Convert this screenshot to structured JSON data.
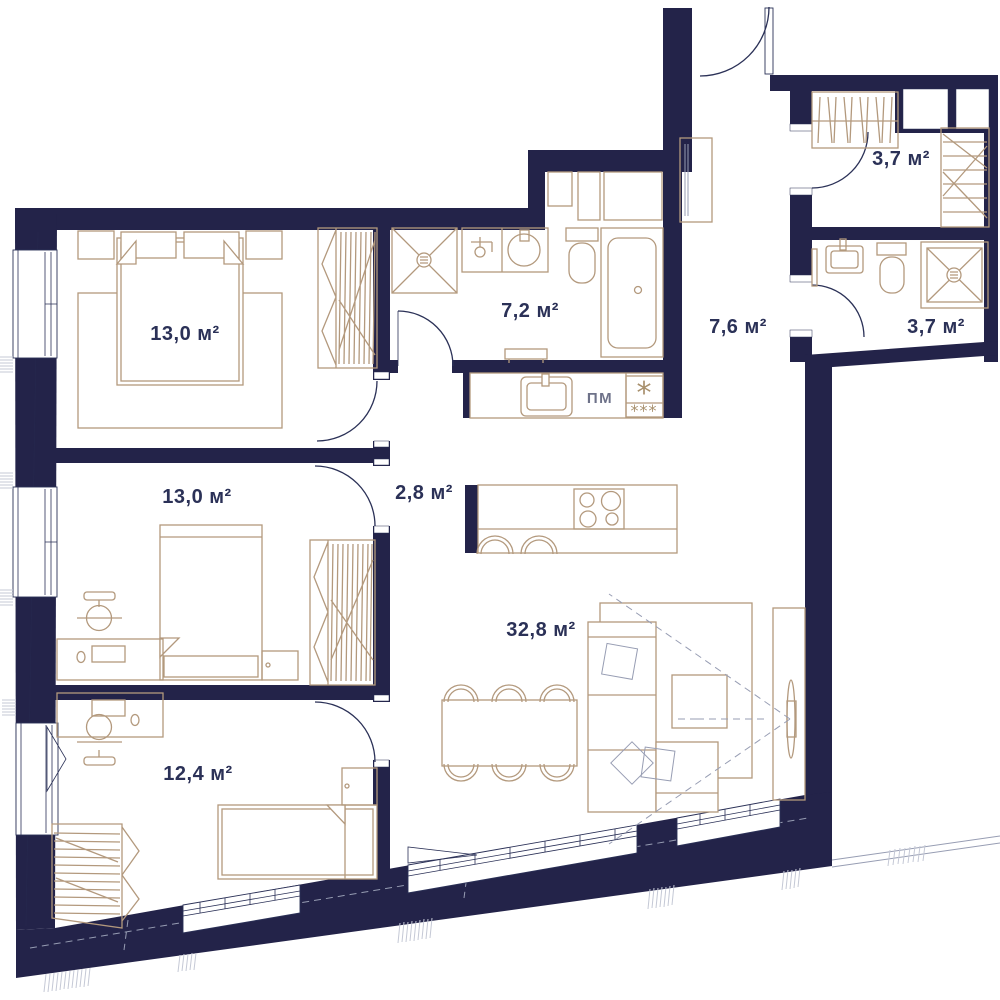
{
  "plan": {
    "unit": "м²",
    "rooms": [
      {
        "name": "bedroom-top",
        "area_label": "13,0 м²"
      },
      {
        "name": "bathroom-main",
        "area_label": "7,2 м²"
      },
      {
        "name": "hallway",
        "area_label": "7,6 м²"
      },
      {
        "name": "dressing-room",
        "area_label": "3,7 м²"
      },
      {
        "name": "bathroom-guest",
        "area_label": "3,7 м²"
      },
      {
        "name": "bedroom-middle",
        "area_label": "13,0 м²"
      },
      {
        "name": "corridor",
        "area_label": "2,8 м²"
      },
      {
        "name": "living-kitchen",
        "area_label": "32,8 м²"
      },
      {
        "name": "bedroom-bottom",
        "area_label": "12,4 м²"
      }
    ],
    "kitchen": {
      "dishwasher_label": "ПМ",
      "fridge_star_top": "*",
      "fridge_star_bottom": "***"
    },
    "colors": {
      "wall": "#232349",
      "furniture_line": "#b3997d",
      "plan_line": "#2b3157",
      "label_text": "#2b3157",
      "muted_gray": "#979db3",
      "background": "#ffffff"
    }
  }
}
